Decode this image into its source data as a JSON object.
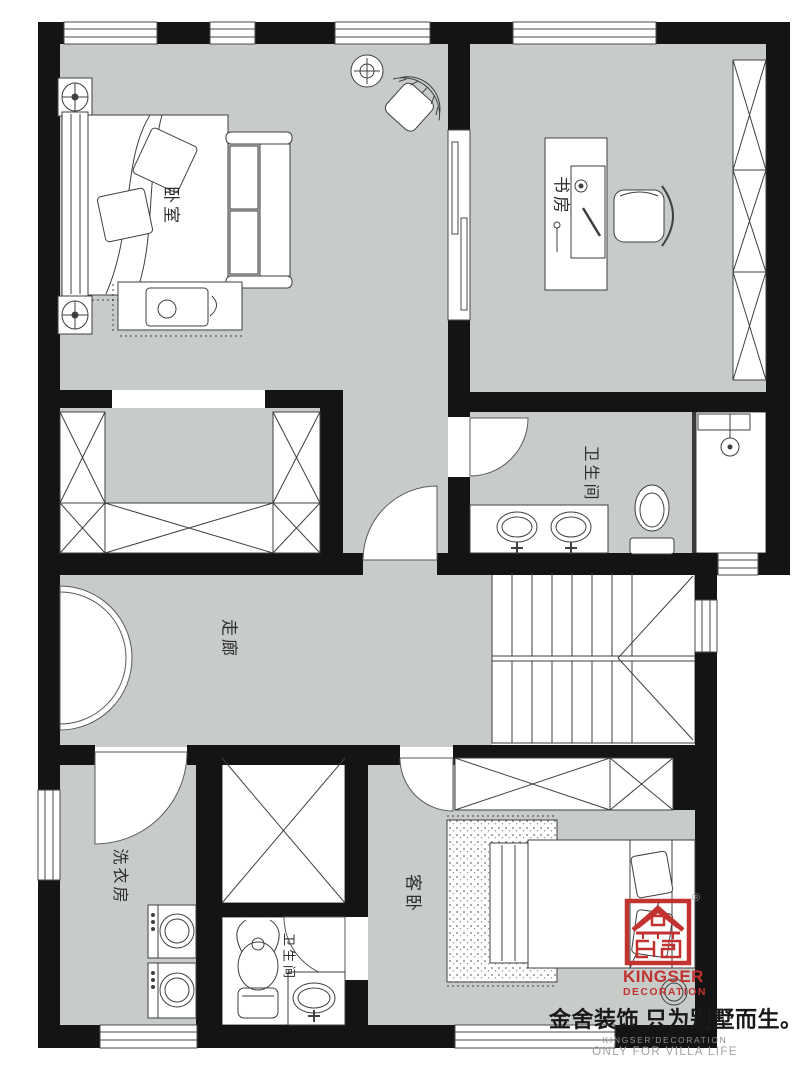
{
  "plan": {
    "title": "second-floor-plan",
    "rooms": [
      {
        "id": "bedroom",
        "label": "卧室"
      },
      {
        "id": "study",
        "label": "书房"
      },
      {
        "id": "bathroom-master",
        "label": "卫生间"
      },
      {
        "id": "corridor",
        "label": "走廊"
      },
      {
        "id": "laundry",
        "label": "洗衣房"
      },
      {
        "id": "bathroom-small",
        "label": "卫生间"
      },
      {
        "id": "guest-bedroom",
        "label": "客卧"
      }
    ],
    "colors": {
      "floor": "#c8ccc9",
      "wall": "#141414",
      "furniture_line": "#3f3f3f",
      "logo_red": "#c23230",
      "slogan_black": "#191919",
      "watermark_grey": "#9da3a5"
    }
  },
  "branding": {
    "logo_name": "KINGSER",
    "logo_sub": "DECORATION",
    "registered_mark": "®",
    "slogan_cn": "金舍装饰 只为别墅而生。",
    "watermark_line1": "KINGSER'DECORATION",
    "watermark_line2": "ONLY FOR VILLA LIFE"
  }
}
